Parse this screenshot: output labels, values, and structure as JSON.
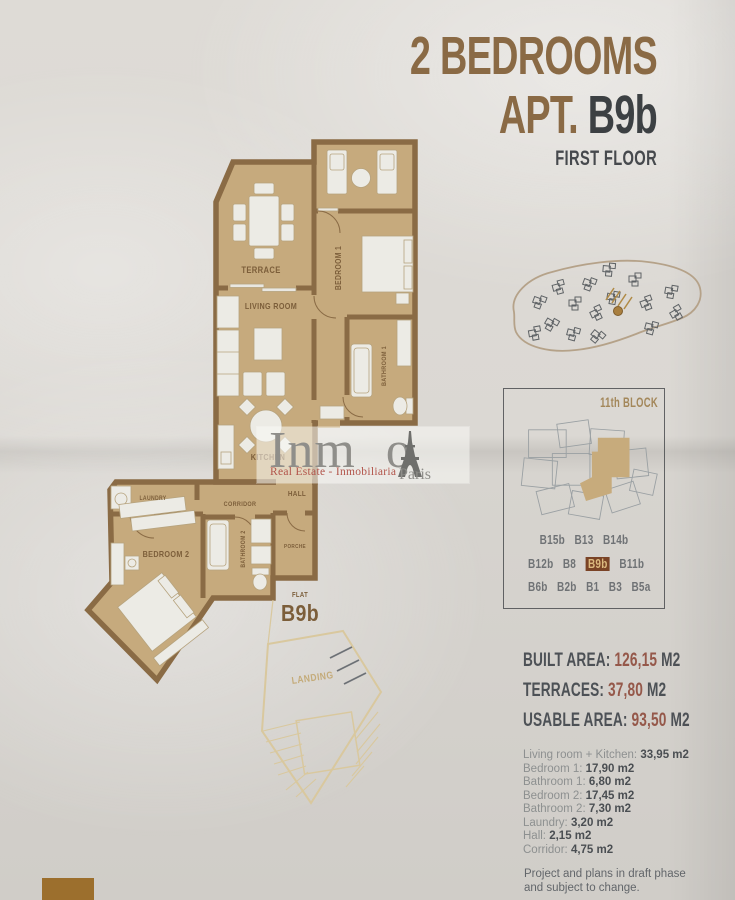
{
  "header": {
    "line1": "2 BEDROOMS",
    "apt_prefix": "APT.",
    "apt_code": "B9b",
    "line3": "FIRST FLOOR"
  },
  "plan": {
    "rooms": {
      "terrace": "TERRACE",
      "living": "LIVING ROOM",
      "bedroom1": "BEDROOM 1",
      "bathroom1": "BATHROOM 1",
      "kitchen": "KITCHEN",
      "laundry": "LAUNDRY",
      "corridor": "CORRIDOR",
      "hall": "HALL",
      "bedroom2": "BEDROOM 2",
      "bathroom2": "BATHROOM 2",
      "porch": "PORCHE",
      "landing": "LANDING"
    },
    "flat": {
      "small": "FLAT",
      "code": "B9b"
    }
  },
  "watermark": {
    "brand_prefix": "Inm",
    "brand_suffix": "o",
    "subtitle": "Real Estate - Inmobiliaria",
    "city": "Paris"
  },
  "block_box": {
    "title": "11th BLOCK",
    "rows": [
      [
        "B15b",
        "B13",
        "B14b"
      ],
      [
        "B12b",
        "B8",
        "B9b",
        "B11b"
      ],
      [
        "B6b",
        "B2b",
        "B1",
        "B3",
        "B5a"
      ]
    ],
    "highlight": "B9b"
  },
  "areas": [
    {
      "label": "BUILT AREA:",
      "value": "126,15",
      "unit": "M2"
    },
    {
      "label": "TERRACES:",
      "value": "37,80",
      "unit": "M2"
    },
    {
      "label": "USABLE AREA:",
      "value": "93,50",
      "unit": "M2"
    }
  ],
  "details": [
    {
      "label": "Living room + Kitchen:",
      "value": "33,95 m2"
    },
    {
      "label": "Bedroom 1:",
      "value": "17,90 m2"
    },
    {
      "label": "Bathroom 1:",
      "value": "6,80 m2"
    },
    {
      "label": "Bedroom 2:",
      "value": "17,45 m2"
    },
    {
      "label": "Bathroom 2:",
      "value": "7,30 m2"
    },
    {
      "label": "Laundry:",
      "value": "3,20 m2"
    },
    {
      "label": "Hall:",
      "value": "2,15 m2"
    },
    {
      "label": "Corridor:",
      "value": "4,75 m2"
    }
  ],
  "disclaimer": {
    "line1": "Project and plans in draft phase",
    "line2": "and subject to change."
  },
  "colors": {
    "accent_brown": "#8a6a45",
    "dark_text": "#3c4043",
    "wall": "#8a6b45",
    "floor": "#c6aa7d",
    "value_red": "#95584a",
    "highlight_bg": "#7a4326",
    "highlight_text": "#dcb97f",
    "pale_outline": "#d9c89e"
  }
}
